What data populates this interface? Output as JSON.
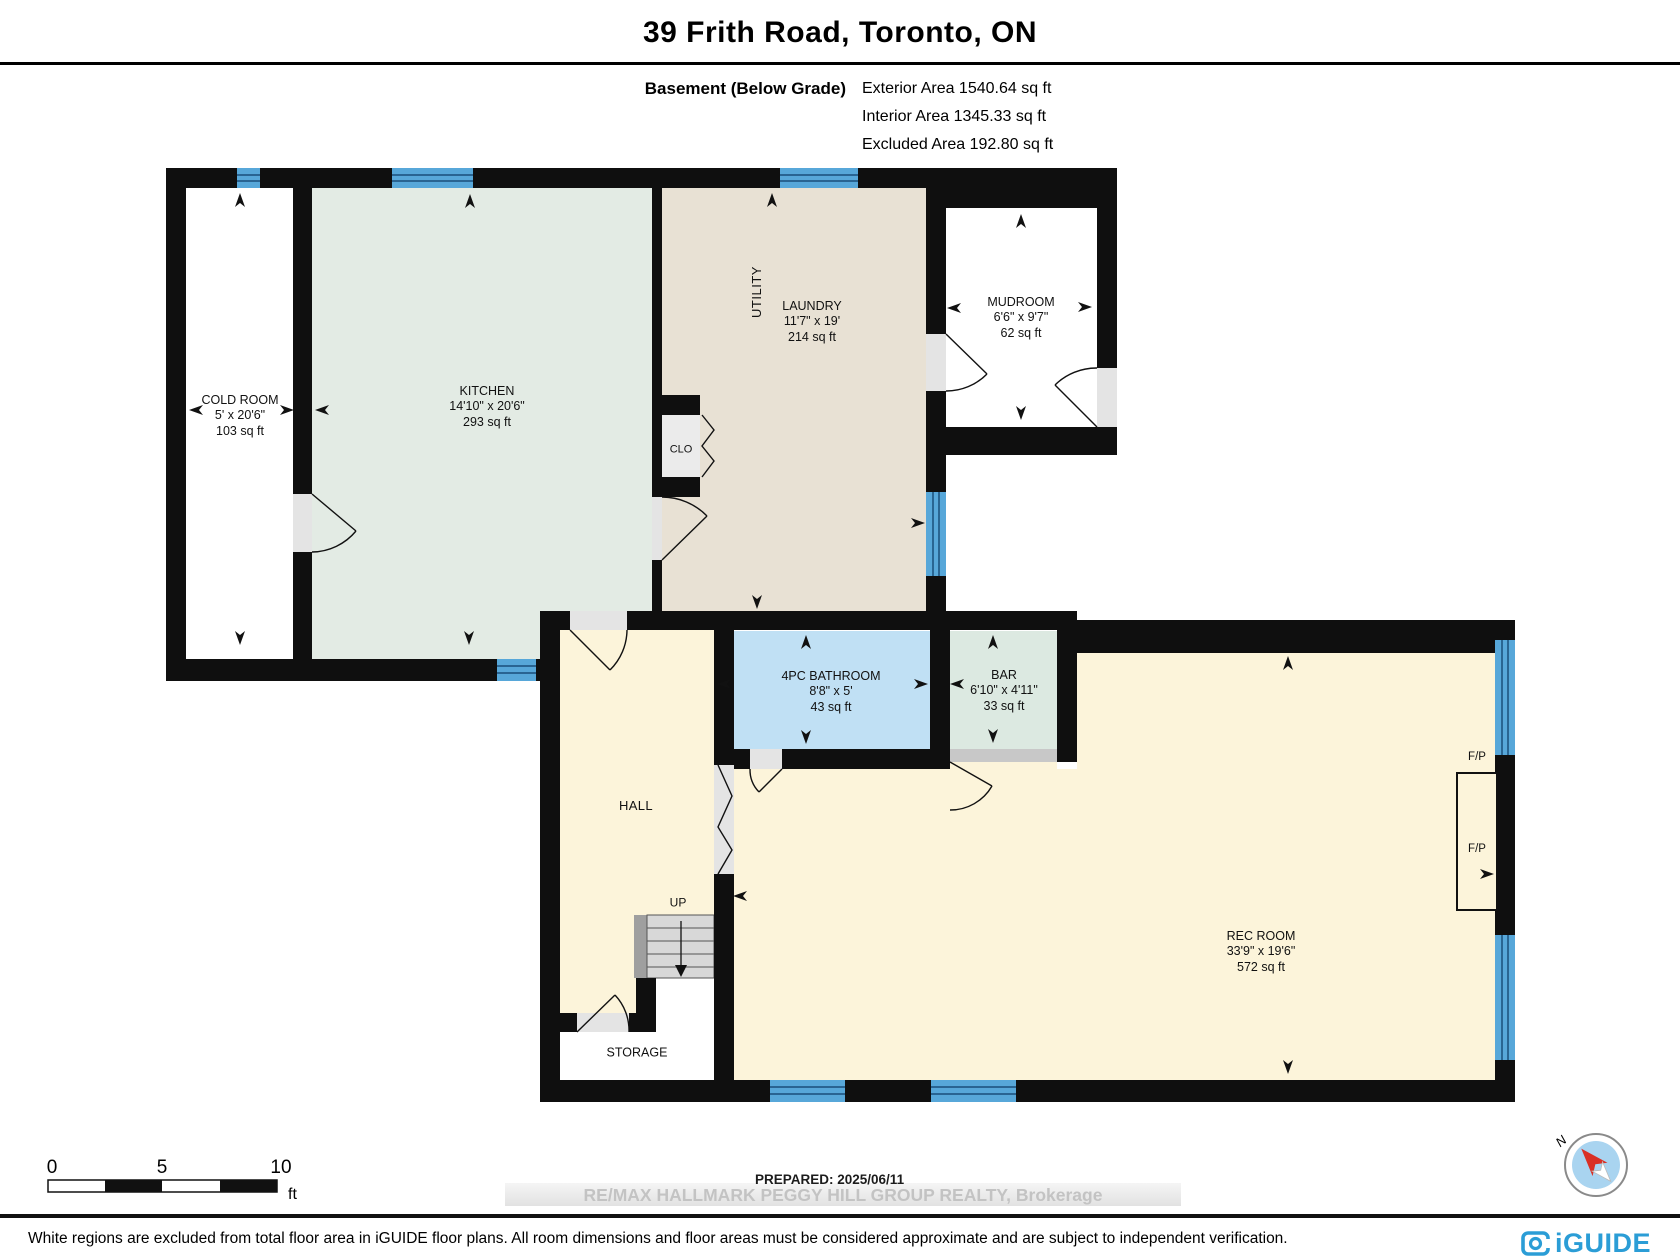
{
  "header": {
    "title": "39 Frith Road, Toronto, ON",
    "floor_label": "Basement (Below Grade)",
    "exterior": "Exterior Area 1540.64 sq ft",
    "interior": "Interior Area 1345.33 sq ft",
    "excluded": "Excluded Area 192.80 sq ft"
  },
  "rooms": {
    "cold": {
      "name": "COLD ROOM",
      "dims": "5' x 20'6\"",
      "area": "103 sq ft"
    },
    "kitchen": {
      "name": "KITCHEN",
      "dims": "14'10\" x 20'6\"",
      "area": "293 sq ft"
    },
    "laundry": {
      "name": "LAUNDRY",
      "dims": "11'7\" x 19'",
      "area": "214 sq ft"
    },
    "utility": {
      "name": "UTILITY"
    },
    "closet": {
      "name": "CLO"
    },
    "mudroom": {
      "name": "MUDROOM",
      "dims": "6'6\" x 9'7\"",
      "area": "62 sq ft"
    },
    "bathroom": {
      "name": "4PC BATHROOM",
      "dims": "8'8\" x 5'",
      "area": "43 sq ft"
    },
    "bar": {
      "name": "BAR",
      "dims": "6'10\" x 4'11\"",
      "area": "33 sq ft"
    },
    "hall": {
      "name": "HALL"
    },
    "stairs": {
      "name": "UP"
    },
    "storage": {
      "name": "STORAGE"
    },
    "rec": {
      "name": "REC ROOM",
      "dims": "33'9\" x 19'6\"",
      "area": "572 sq ft"
    },
    "fireplace": {
      "name": "F/P"
    }
  },
  "scale_bar": {
    "tick_0": "0",
    "tick_5": "5",
    "tick_10": "10",
    "unit": "ft"
  },
  "compass": {
    "north": "N"
  },
  "footer": {
    "prepared": "PREPARED: 2025/06/11",
    "watermark": "RE/MAX HALLMARK PEGGY HILL GROUP REALTY, Brokerage",
    "disclaimer": "White regions are excluded from total floor area in iGUIDE floor plans. All room dimensions and floor areas must be considered approximate and are subject to independent verification.",
    "brand": "iGUIDE"
  },
  "colors": {
    "wall": "#0f0f0f",
    "window": "#57a7d9",
    "kitchen": "#e3ebe4",
    "laundry": "#e8e1d4",
    "bathroom": "#c0e0f4",
    "bar": "#dce9e1",
    "cream": "#fcf4da",
    "brand_blue": "#2b9dd6",
    "compass_red": "#d93025"
  }
}
